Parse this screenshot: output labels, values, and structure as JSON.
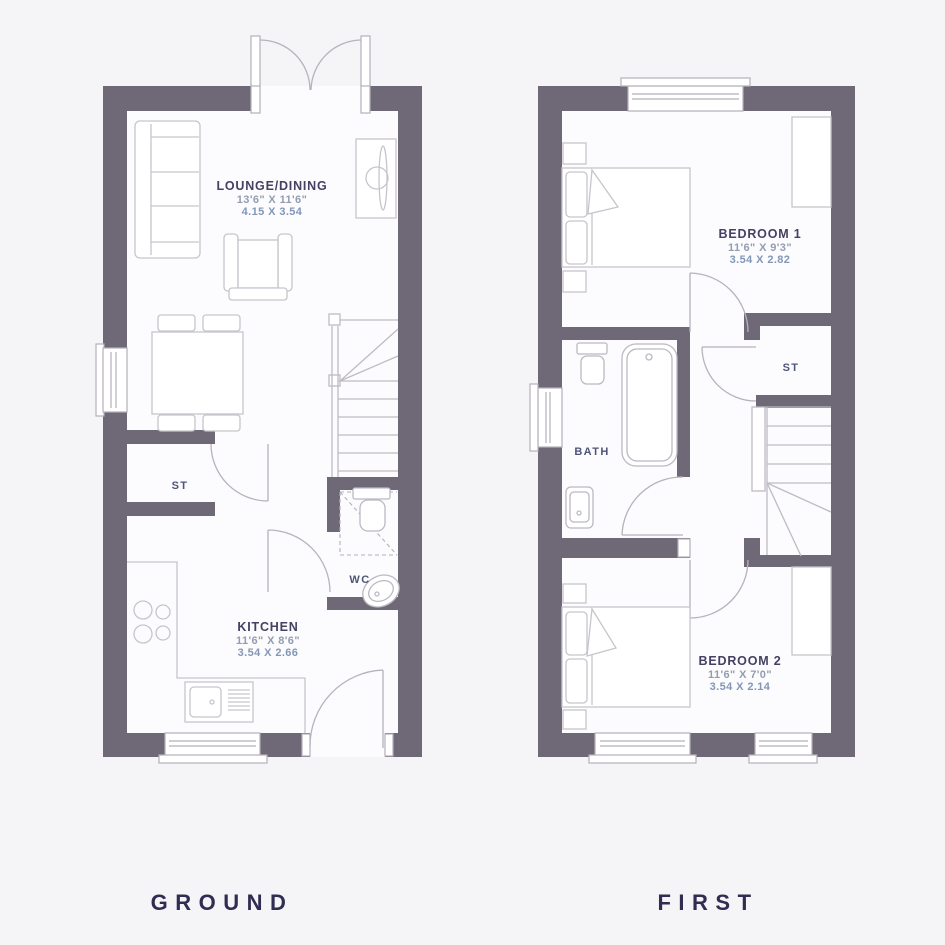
{
  "meta": {
    "type": "house-floorplan",
    "background_color": "#f5f4f6",
    "wall_color": "#6f6876",
    "line_color": "#c7c5cc",
    "title_color": "#454163",
    "imperial_dim_color": "#939db0",
    "metric_dim_color": "#8297b8",
    "floor_label_color": "#312d52"
  },
  "ground": {
    "title": "GROUND",
    "lounge": {
      "name": "LOUNGE/DINING",
      "imperial": "13'6\" X 11'6\"",
      "metric": "4.15 X 3.54"
    },
    "kitchen": {
      "name": "KITCHEN",
      "imperial": "11'6\" X 8'6\"",
      "metric": "3.54 X 2.66"
    },
    "store": {
      "name": "ST"
    },
    "wc": {
      "name": "WC"
    }
  },
  "first": {
    "title": "FIRST",
    "bedroom1": {
      "name": "BEDROOM 1",
      "imperial": "11'6\" X 9'3\"",
      "metric": "3.54 X 2.82"
    },
    "bedroom2": {
      "name": "BEDROOM 2",
      "imperial": "11'6\" X 7'0\"",
      "metric": "3.54 X 2.14"
    },
    "bath": {
      "name": "BATH"
    },
    "store": {
      "name": "ST"
    }
  }
}
